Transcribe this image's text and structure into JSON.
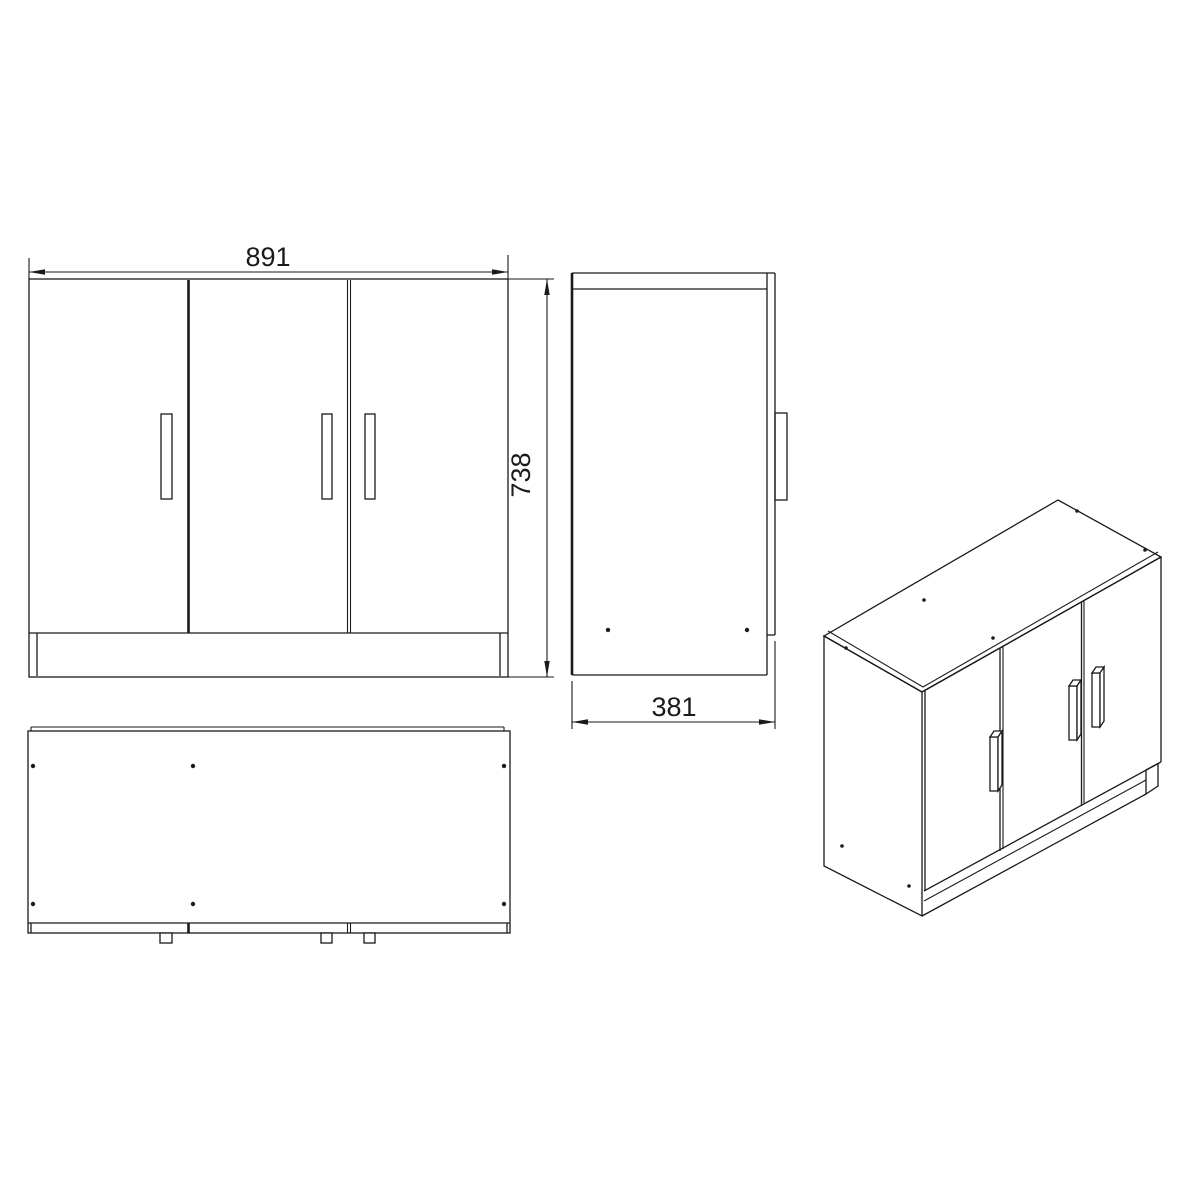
{
  "drawing": {
    "kind": "cabinet-technical-drawing",
    "background_color": "#ffffff",
    "ink_color": "#1a1a1a",
    "dimensions": {
      "width": "891",
      "height": "738",
      "depth": "381"
    },
    "views": {
      "front": {
        "door_count": 3,
        "handle_count": 3
      },
      "side": {
        "hole_dots": 2
      },
      "top": {
        "hole_dots": 6,
        "handle_tabs": 3
      },
      "isometric": {
        "door_count": 3,
        "handle_count": 3
      }
    }
  }
}
